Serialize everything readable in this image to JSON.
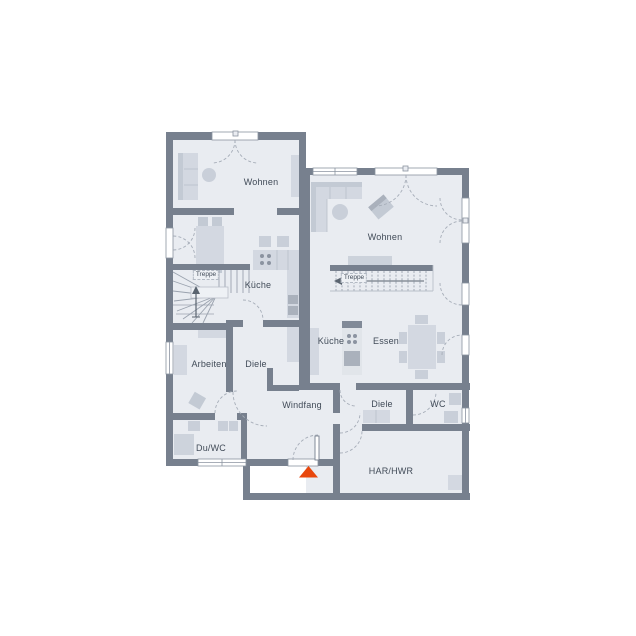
{
  "plan": {
    "type": "floor-plan",
    "rooms": {
      "left": {
        "wohnen": "Wohnen",
        "treppe": "Treppe",
        "kueche": "Küche",
        "arbeiten": "Arbeiten",
        "diele": "Diele",
        "du_wc": "Du/WC"
      },
      "shared": {
        "windfang": "Windfang"
      },
      "right": {
        "wohnen": "Wohnen",
        "treppe": "Treppe",
        "kueche": "Küche",
        "essen": "Essen",
        "diele": "Diele",
        "wc": "WC",
        "har_hwr": "HAR/HWR"
      }
    },
    "icons": {
      "entrance_marker": "entrance-triangle-up"
    },
    "colors": {
      "background": "#ffffff",
      "wall": "#77808e",
      "floor": "#e9ecf1",
      "furniture_light": "#d3d8e1",
      "furniture_mid": "#c3cad4",
      "appliance_dark": "#aab1bc",
      "stair_lines": "#9aa2ae",
      "door_arc": "#a6adb8",
      "entrance_marker": "#e8470c",
      "label_text": "#414b58"
    }
  }
}
